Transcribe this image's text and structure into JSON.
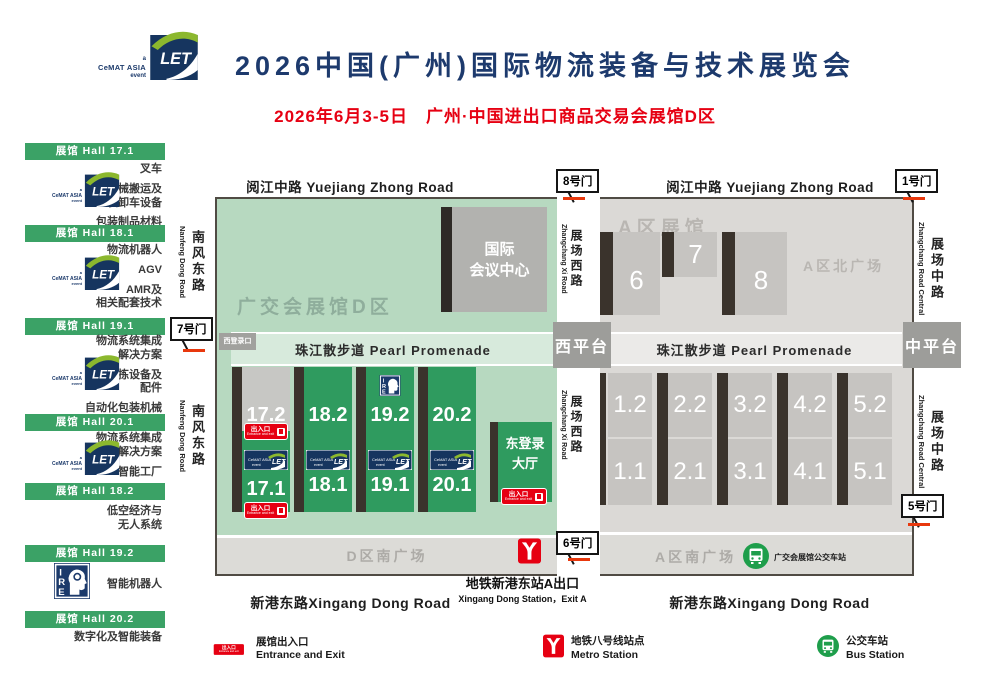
{
  "header": {
    "brand": {
      "a": "a",
      "cemat": "CeMAT ASIA",
      "event": "event"
    },
    "title": "2026中国(广州)国际物流装备与技术展览会",
    "subtitle": "2026年6月3-5日　广州·中国进出口商品交易会展馆D区"
  },
  "sidebar": {
    "sections": [
      {
        "header": "展馆 Hall 17.1",
        "items": [
          "叉车",
          "机械搬运及\n装卸车设备",
          "包装制品材料"
        ]
      },
      {
        "header": "展馆 Hall 18.1",
        "items": [
          "物流机器人",
          "AGV",
          "AMR及\n相关配套技术"
        ]
      },
      {
        "header": "展馆 Hall 19.1",
        "items": [
          "物流系统集成\n解决方案",
          "输送分拣设备及\n配件",
          "自动化包装机械"
        ]
      },
      {
        "header": "展馆 Hall 20.1",
        "items": [
          "物流系统集成\n解决方案",
          "智能工厂"
        ]
      },
      {
        "header": "展馆 Hall 18.2",
        "items": [
          "低空经济与\n无人系统"
        ]
      },
      {
        "header": "展馆 Hall 19.2",
        "items": [
          "智能机器人"
        ]
      },
      {
        "header": "展馆 Hall 20.2",
        "items": [
          "数字化及智能装备"
        ]
      }
    ]
  },
  "map": {
    "roads": {
      "yuejiang": "阅江中路  Yuejiang Zhong Road",
      "xingang": "新港东路Xingang Dong Road",
      "nanfeng_cn": "南风东路",
      "nanfeng_en": "Nanfeng Dong Road",
      "zhangchang_xi_cn": "展场西路",
      "zhangchang_xi_en": "Zhangchang Xi Road",
      "zhangchang_zhong_cn": "展场中路",
      "zhangchang_zhong_en": "Zhangchang Road Central"
    },
    "gates": {
      "g1": "1号门",
      "g5": "5号门",
      "g6": "6号门",
      "g7": "7号门",
      "g8": "8号门"
    },
    "promenade": "珠江散步道 Pearl Promenade",
    "west_platform": "西平台",
    "central_platform": "中平台",
    "d_zone": {
      "area_label": "广交会展馆D区",
      "convention_center": "国际\n会议中心",
      "west_login": "西登录口",
      "towers": [
        {
          "upper": "17.2",
          "lower": "17.1"
        },
        {
          "upper": "18.2",
          "lower": "18.1"
        },
        {
          "upper": "19.2",
          "lower": "19.1"
        },
        {
          "upper": "20.2",
          "lower": "20.1"
        }
      ],
      "east_hall": "东登录\n大厅",
      "south_plaza": "D区南广场"
    },
    "a_zone": {
      "area_label": "A区展馆",
      "north_plaza": "A区北广场",
      "halls_north": [
        "6",
        "7",
        "8"
      ],
      "towers": [
        {
          "upper": "1.2",
          "lower": "1.1"
        },
        {
          "upper": "2.2",
          "lower": "2.1"
        },
        {
          "upper": "3.2",
          "lower": "3.1"
        },
        {
          "upper": "4.2",
          "lower": "4.1"
        },
        {
          "upper": "5.2",
          "lower": "5.1"
        }
      ],
      "south_plaza": "A区南广场",
      "bus_station": "广交会展馆公交车站"
    },
    "entrance_badge": {
      "cn": "出入口",
      "en": "Entrance and exit"
    },
    "metro_exit": {
      "cn": "地铁新港东站A出口",
      "en": "Xingang Dong Station，Exit A"
    }
  },
  "legend": {
    "entrance": {
      "cn": "展馆出入口",
      "en": "Entrance and Exit"
    },
    "metro": {
      "cn": "地铁八号线站点",
      "en": "Metro Station"
    },
    "bus": {
      "cn": "公交车站",
      "en": "Bus Station"
    }
  },
  "colors": {
    "navy": "#1d3a6d",
    "red": "#e60012",
    "green_bar": "#3ba266",
    "hall_green": "#2f9b5f",
    "d_bg": "#b7d9c0",
    "a_bg": "#dbd9d6",
    "gate_line": "#e8380d"
  }
}
